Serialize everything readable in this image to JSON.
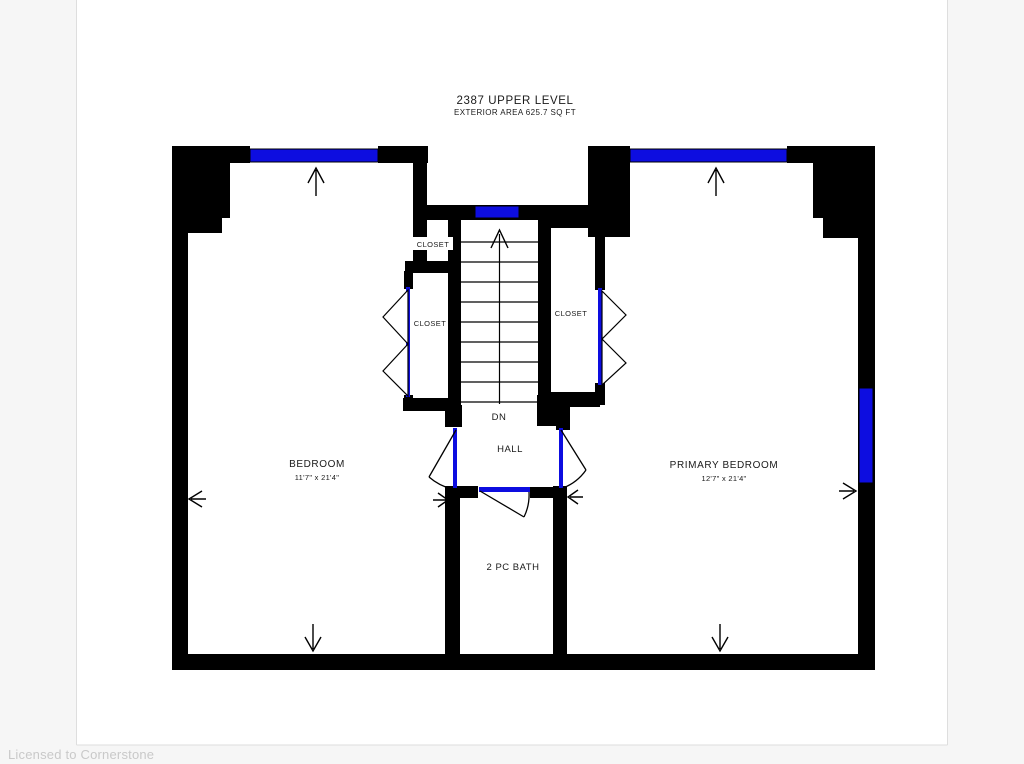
{
  "watermark": "Licensed to Cornerstone",
  "floorplan": {
    "title": "2387 UPPER LEVEL",
    "subtitle": "EXTERIOR AREA 625.7 SQ FT",
    "rooms": {
      "bedroom": {
        "label": "BEDROOM",
        "dims": "11'7\" x 21'4\""
      },
      "primary_bedroom": {
        "label": "PRIMARY BEDROOM",
        "dims": "12'7\" x 21'4\""
      },
      "hall": {
        "label": "HALL"
      },
      "bath": {
        "label": "2 PC BATH"
      },
      "closet_top": {
        "label": "CLOSET"
      },
      "closet_left": {
        "label": "CLOSET"
      },
      "closet_right": {
        "label": "CLOSET"
      }
    },
    "stairs": {
      "label": "DN"
    },
    "colors": {
      "wall": "#000000",
      "window_door": "#0d0de0",
      "text": "#1a1a1a",
      "watermark": "#c9c9c9",
      "page_background": "#ffffff",
      "canvas_background": "#f6f6f6"
    }
  }
}
